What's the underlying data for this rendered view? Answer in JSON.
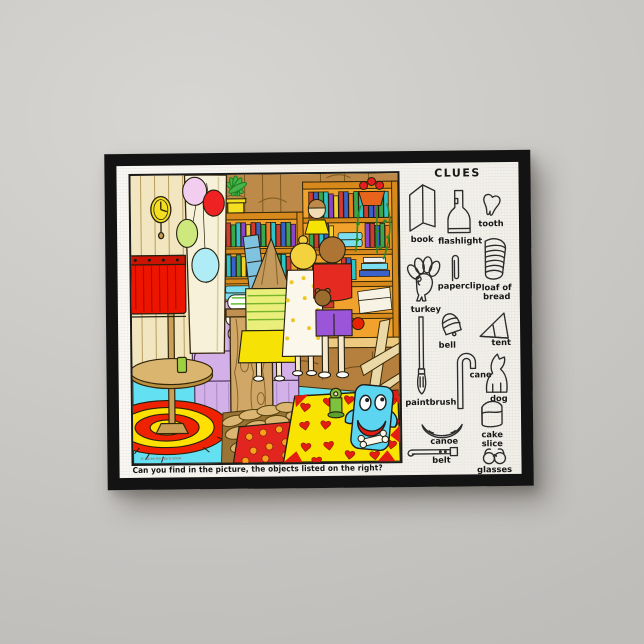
{
  "puzzle": {
    "caption": "Can you find in the picture, the objects listed on the right?",
    "copyright": "© Karen Bo Ward 2004",
    "clues": {
      "title": "CLUES",
      "items": [
        {
          "label": "book",
          "icon": "book-icon"
        },
        {
          "label": "flashlight",
          "icon": "flashlight-icon"
        },
        {
          "label": "tooth",
          "icon": "tooth-icon"
        },
        {
          "label": "turkey",
          "icon": "turkey-icon"
        },
        {
          "label": "paperclip",
          "icon": "paperclip-icon"
        },
        {
          "label": "loaf of bread",
          "icon": "bread-icon"
        },
        {
          "label": "bell",
          "icon": "bell-icon"
        },
        {
          "label": "tent",
          "icon": "tent-icon"
        },
        {
          "label": "paintbrush",
          "icon": "paintbrush-icon"
        },
        {
          "label": "cane",
          "icon": "cane-icon"
        },
        {
          "label": "dog",
          "icon": "dog-icon"
        },
        {
          "label": "canoe",
          "icon": "canoe-icon"
        },
        {
          "label": "cake slice",
          "icon": "cake-slice-icon"
        },
        {
          "label": "belt",
          "icon": "belt-icon"
        },
        {
          "label": "glasses",
          "icon": "glasses-icon"
        }
      ]
    },
    "palette": {
      "wall_gray": "#cccac7",
      "frame_black": "#131313",
      "canvas_white": "#f7f5f0",
      "scene_wall_beige": "#f2e6c0",
      "wood_brown": "#bd8a4a",
      "shelf_orange": "#f0a22c",
      "floor_cyan": "#63e0f2",
      "lamp_red": "#ee1500",
      "armchair_lavender": "#d9b9ec",
      "rug_yellow": "#f8e400",
      "heart_red": "#e41d12",
      "monster_cyan": "#5cd6f0",
      "bullseye_red": "#ee2200",
      "bullseye_yellow": "#ffe000"
    }
  }
}
